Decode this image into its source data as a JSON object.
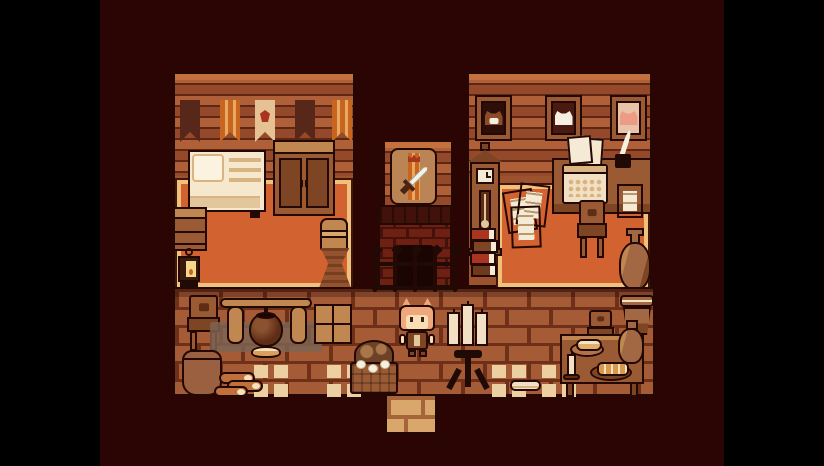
{
  "scene": {
    "name": "pixel-cabin-interior",
    "genre": "top-down pixel-art RPG interior",
    "visible_text": [],
    "viewport": {
      "width": 824,
      "height": 466,
      "letterbox": "black bars on left and right",
      "stage_left": 100,
      "stage_width": 624
    }
  },
  "palette": {
    "black": "#000000",
    "void": "#2b0503",
    "outline": "#240803",
    "wall_light": "#c4713f",
    "wall_mid": "#b06038",
    "wall_dark": "#94492a",
    "wall_seam": "#5f2614",
    "banner_dark": "#57281a",
    "banner_orange": "#c7651f",
    "banner_gold": "#e9a861",
    "banner_cream": "#e5c193",
    "banner_red": "#a93420",
    "rug_orange": "#d2622f",
    "rug_border": "#efc27c",
    "rug_edge": "#46130b",
    "room_floor": "#9c512f",
    "cream": "#f6e8cc",
    "cream_dark": "#e2c79c",
    "tan": "#d9b483",
    "wood_light": "#c08850",
    "wood_mid": "#9a5a33",
    "wood_dark": "#7e4525",
    "wood_deep": "#5f2c16",
    "brick_face": "#a55c36",
    "brick_line": "#6e3018",
    "fire_brick": "#6e2013",
    "fire_seam": "#44120a",
    "fire_top": "#411209",
    "firebox": "#1a0503",
    "metal": "#1f0a05",
    "skin": "#f8ddb5",
    "hair": "#efa87c",
    "hair_dark": "#d9885a",
    "clay": "#a26844",
    "clay_light": "#c08850",
    "paper": "#f5ead5",
    "paper_line": "#b89a6a",
    "tile_light": "#ecd0a2",
    "corridor_face": "#d9a76b",
    "corridor_line": "#a5643a",
    "gray_mat": "#7d6352",
    "egg_white": "#f5f0e0",
    "bread": "#e0b06a",
    "bread_light": "#f5e3c0",
    "pie": "#d89a4a",
    "red_book": "#a93420",
    "pink_cat": "#ec9b85",
    "frame_mat_dark": "#2e0e08",
    "frame_mat_brown": "#4a1a10",
    "frame_mat_pink": "#e8c3a8",
    "blade": "#f2f2e8",
    "plaque": "#bb8455"
  },
  "entities": {
    "left_room": [
      "wall-with-banners",
      "bed",
      "wardrobe",
      "dresser",
      "lantern",
      "sack",
      "woven-basket",
      "orange-rug"
    ],
    "center": [
      "sword-plaque",
      "brick-fireplace",
      "iron-fence"
    ],
    "right_room": [
      "portrait-dog",
      "portrait-sheep",
      "portrait-cat",
      "grandfather-clock",
      "book-stack",
      "paper-pile",
      "writing-desk",
      "typewriter",
      "quill-and-inkpot",
      "desk-papers",
      "chair",
      "clay-vase",
      "orange-rug"
    ],
    "common_floor": [
      "chair",
      "cooking-tripod",
      "cauldron",
      "floor-mat",
      "crate",
      "clay-pot",
      "firewood-logs",
      "pale-floor-tiles",
      "egg-basket",
      "cat-eared-character",
      "candelabra-stand",
      "dining-table",
      "bread-on-plate",
      "pie-on-plate",
      "table-candle",
      "jug",
      "chair",
      "clay-pot",
      "bread-loaf",
      "exit-corridor"
    ]
  }
}
